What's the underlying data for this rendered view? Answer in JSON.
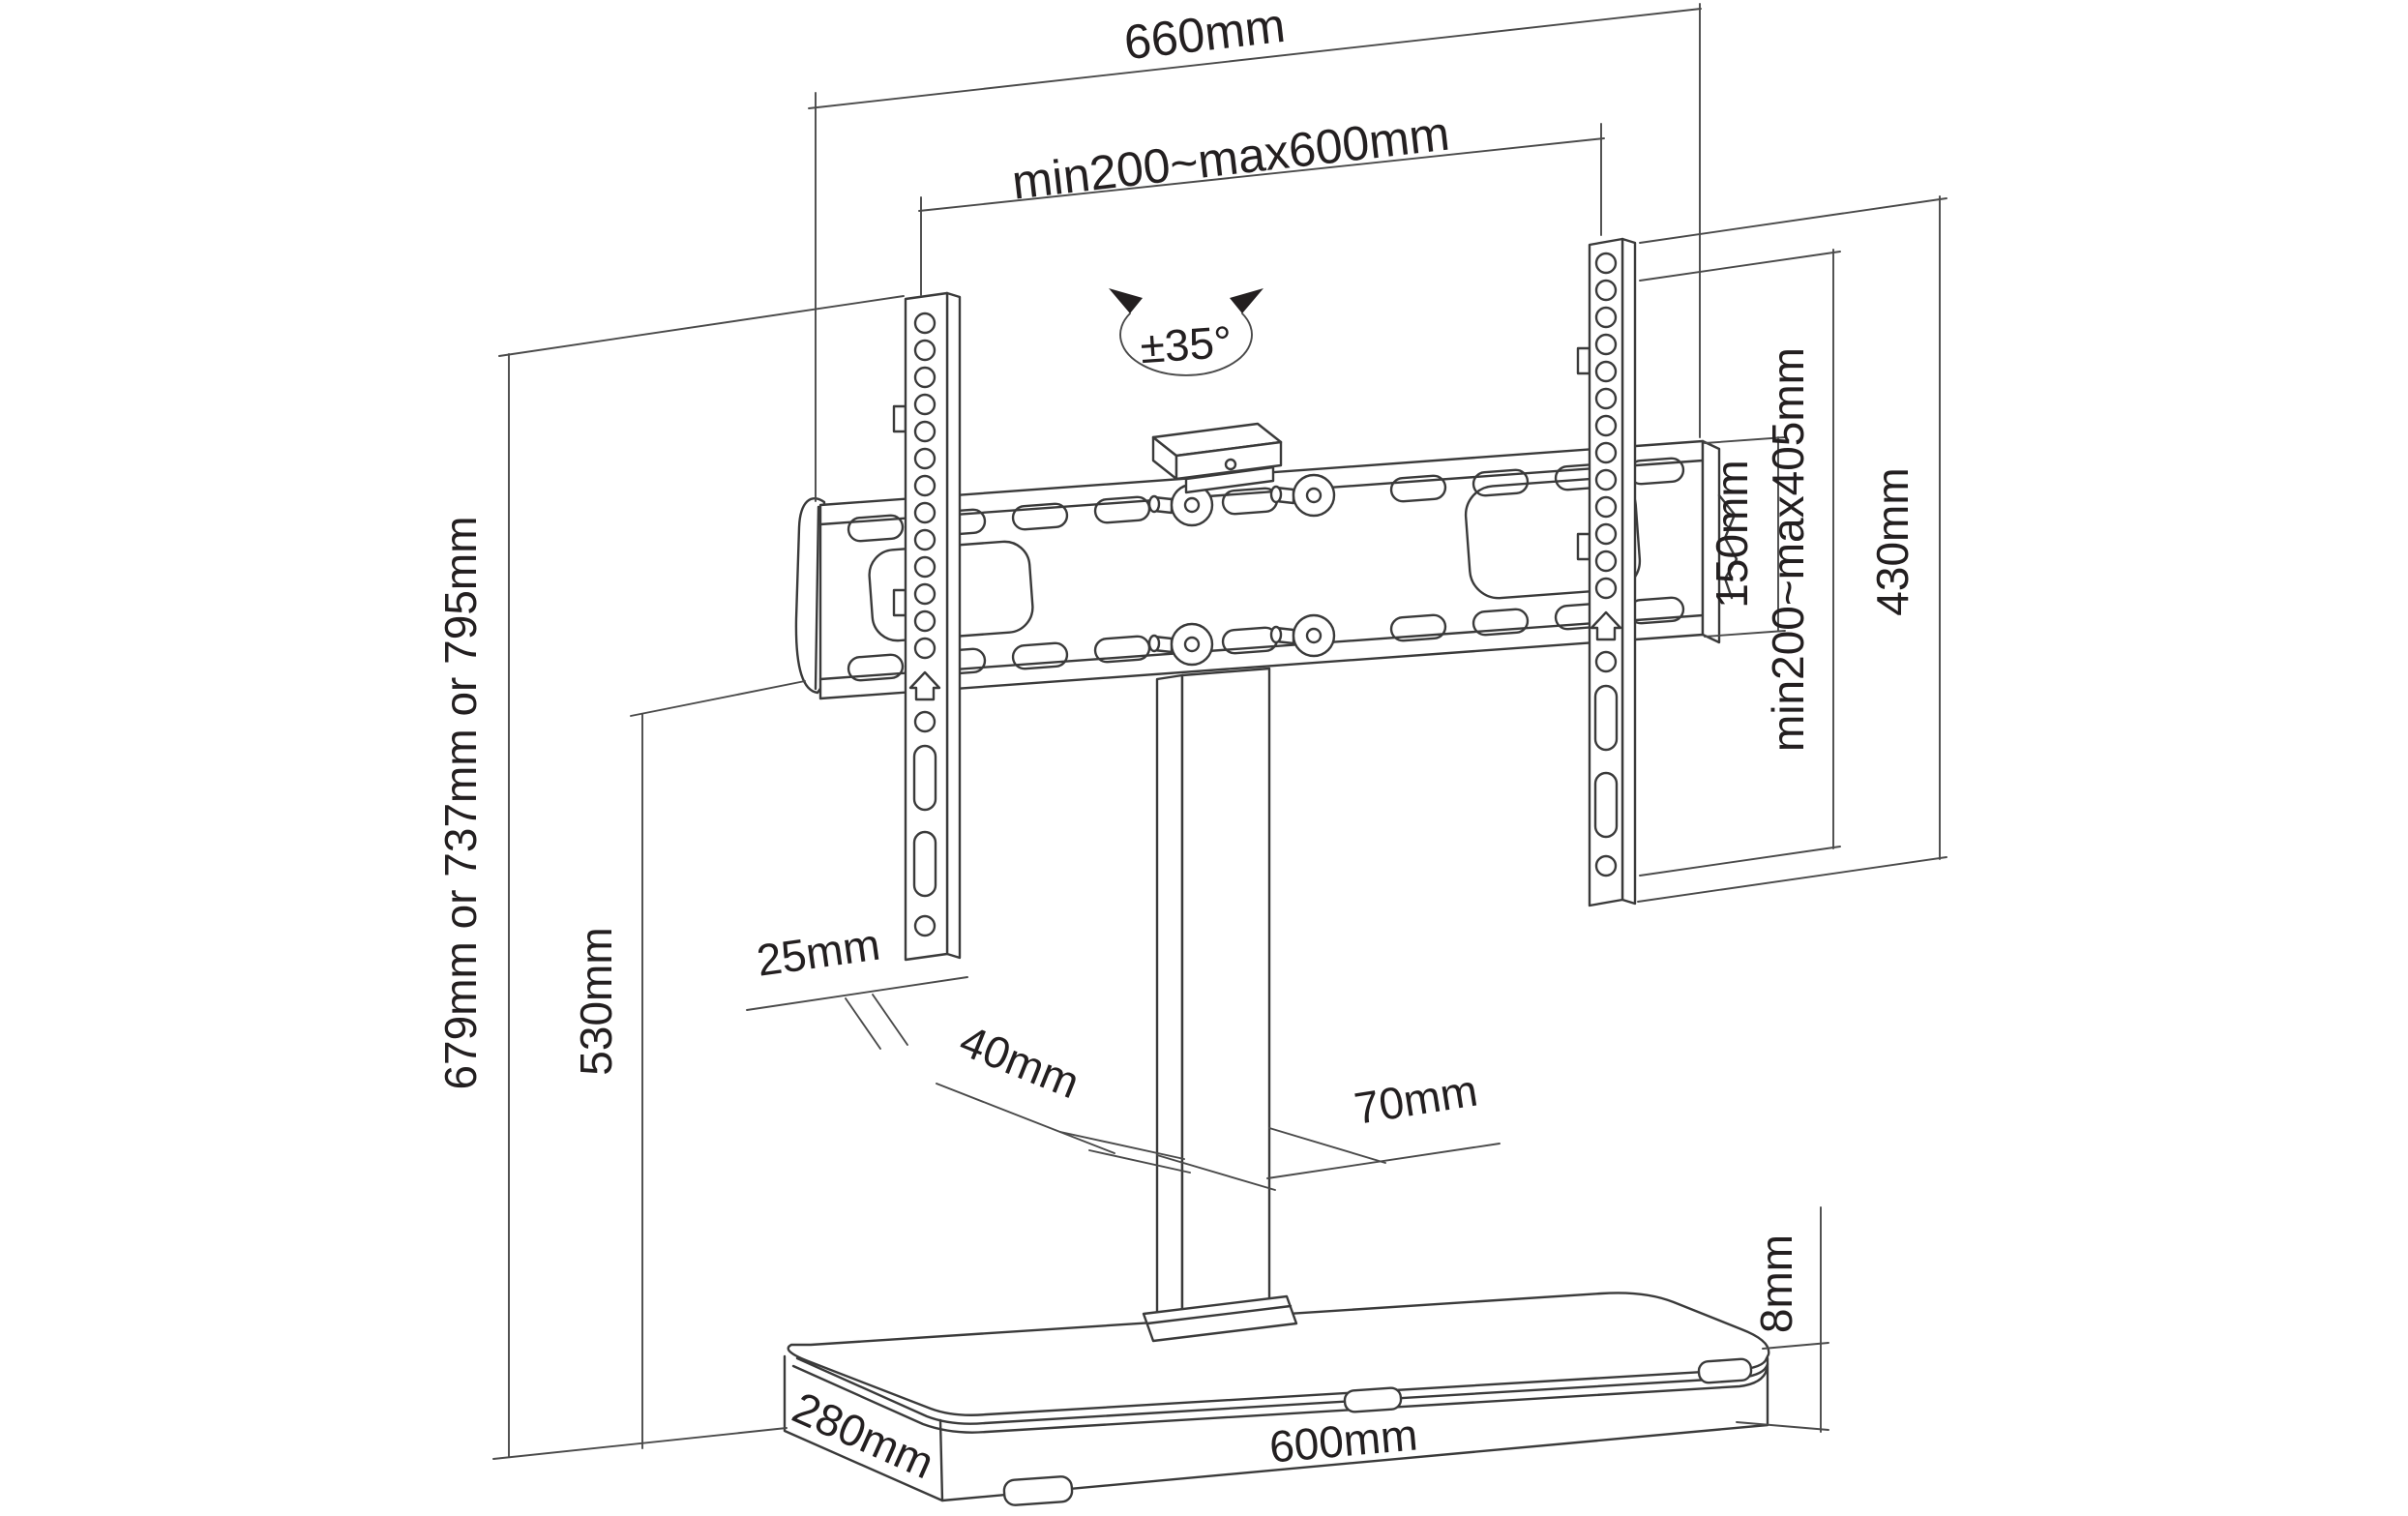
{
  "colors": {
    "background": "#ffffff",
    "line": "#3a3a3a",
    "dimension_line": "#4a4a4a",
    "text": "#231f20"
  },
  "dimensions": {
    "overall_width": {
      "text": "660mm"
    },
    "vesa_width_range": {
      "text": "min200~max600mm"
    },
    "swivel_angle": {
      "text": "±35°"
    },
    "vesa_height_range": {
      "text": "min200~max405mm"
    },
    "bracket_height": {
      "text": "430mm"
    },
    "plate_height": {
      "text": "150mm"
    },
    "overall_height_options": {
      "text": "679mm or 737mm or 795mm"
    },
    "column_height": {
      "text": "530mm"
    },
    "bracket_offset": {
      "text": "25mm"
    },
    "column_depth": {
      "text": "40mm"
    },
    "column_width": {
      "text": "70mm"
    },
    "base_thickness": {
      "text": "8mm"
    },
    "base_depth": {
      "text": "280mm"
    },
    "base_width": {
      "text": "600mm"
    }
  }
}
